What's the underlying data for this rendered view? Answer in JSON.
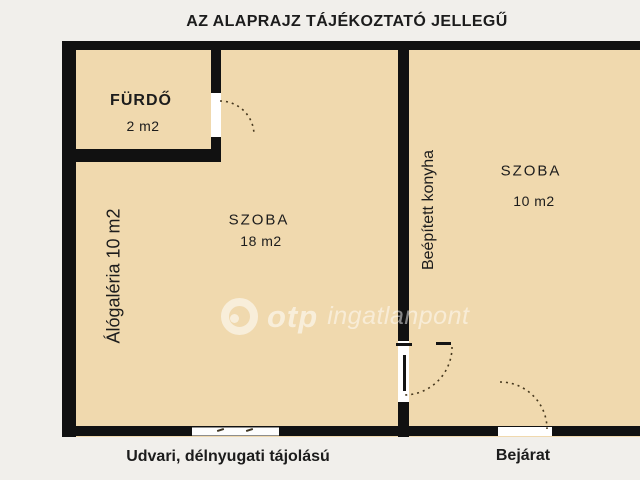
{
  "title": "AZ ALAPRAJZ TÁJÉKOZTATÓ JELLEGŰ",
  "rooms": {
    "furdo": {
      "name": "FÜRDŐ",
      "area": "2 m2"
    },
    "szoba_left": {
      "name": "SZOBA",
      "area": "18 m2"
    },
    "szoba_right": {
      "name": "SZOBA",
      "area": "10 m2"
    }
  },
  "vertical_labels": {
    "gallery": "Álógaléria 10 m2",
    "kitchen": "Beépített konyha"
  },
  "captions": {
    "orientation": "Udvari, délnyugati tájolású",
    "entrance": "Bejárat"
  },
  "watermark": {
    "brand": "otp",
    "name": "ingatlanpont"
  },
  "colors": {
    "floor": "#f0d9ae",
    "wall": "#111111",
    "background": "#f1efeb",
    "text": "#1c1c1c",
    "watermark": "rgba(255,255,255,0.55)",
    "door_arc": "#47391f"
  }
}
